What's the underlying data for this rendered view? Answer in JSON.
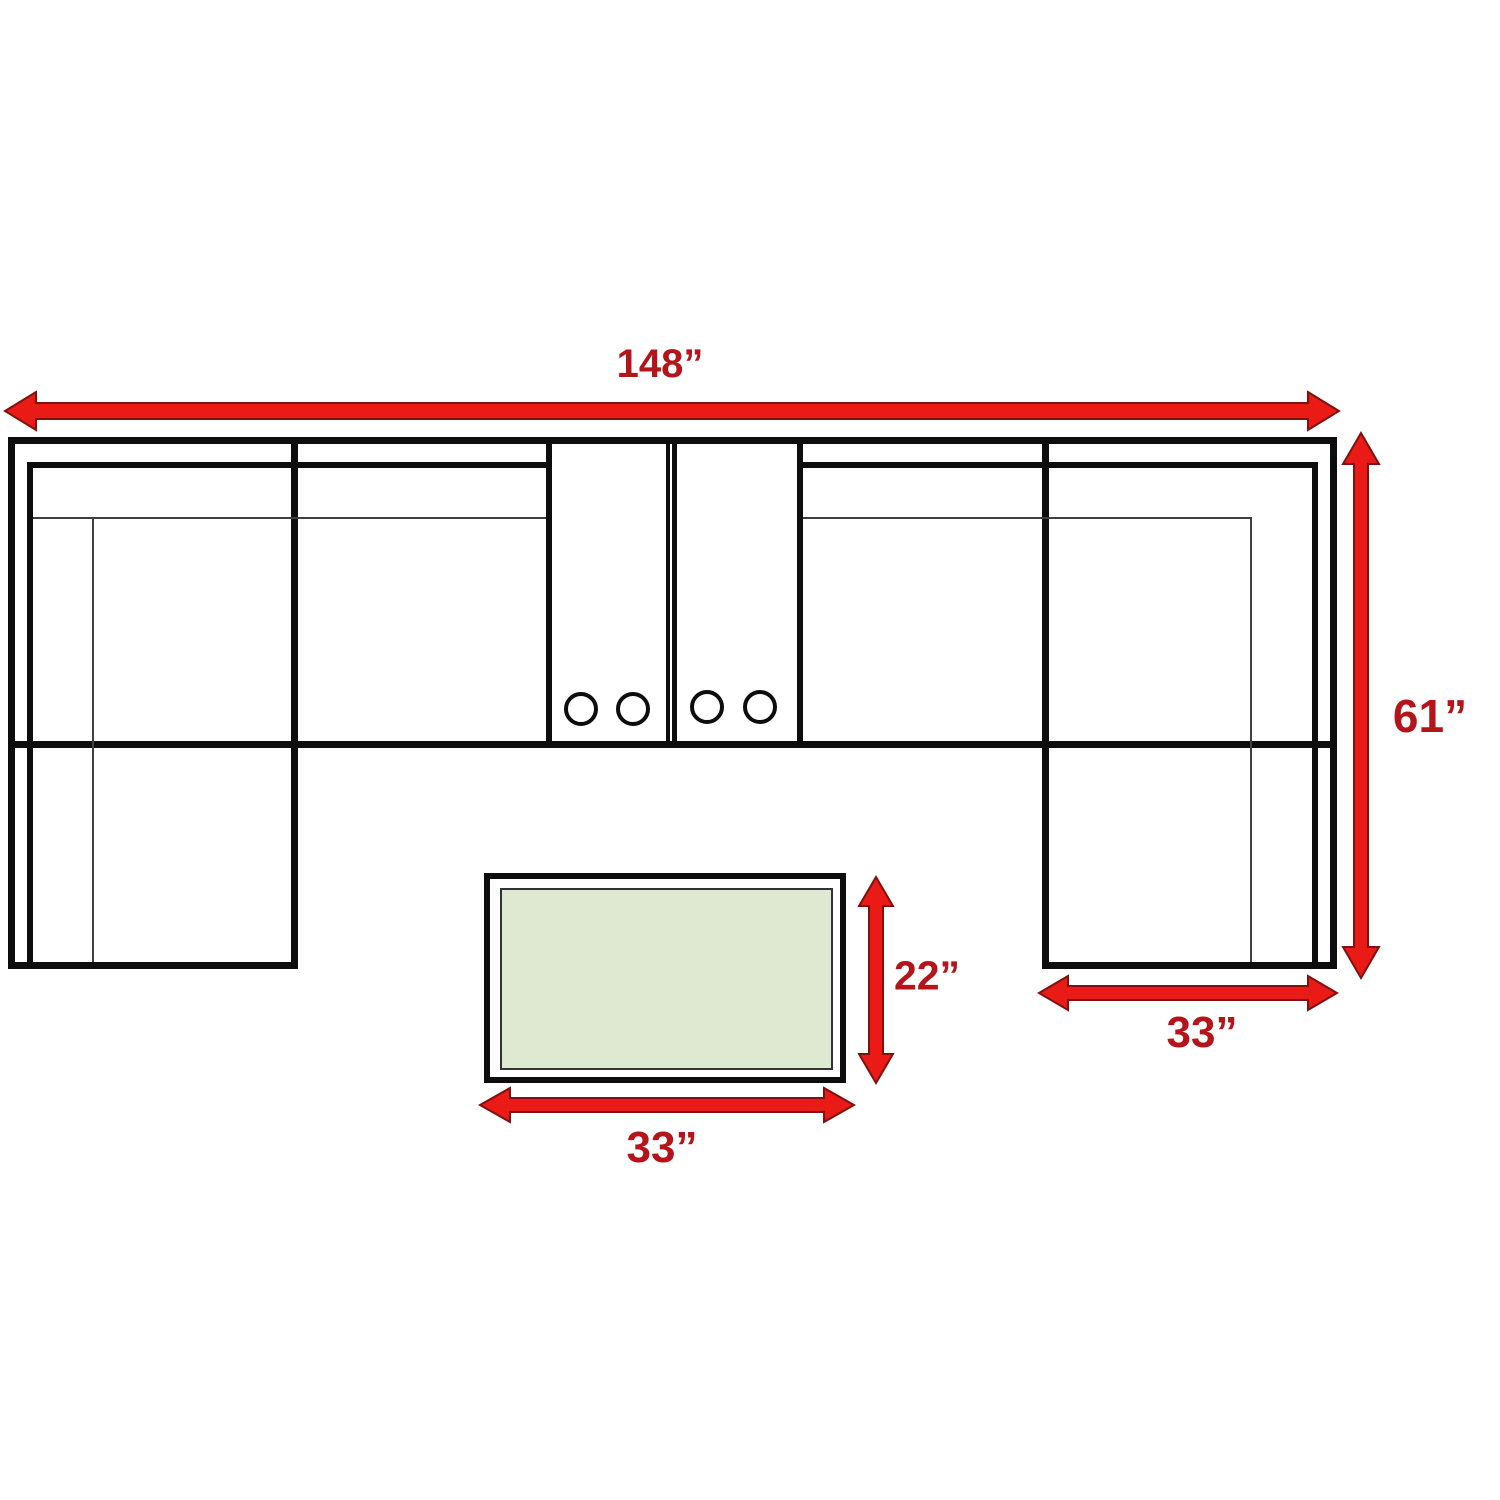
{
  "diagram": {
    "type": "sectional-sofa-floor-plan-with-dimensions",
    "labels": {
      "overall_width": "148”",
      "overall_depth": "61”",
      "chaise_width": "33”",
      "table_depth": "22”",
      "table_width": "33”"
    },
    "dimensions_inches": {
      "overall_width": 148,
      "overall_depth": 61,
      "chaise_width": 33,
      "table_depth": 22,
      "table_width": 33
    },
    "cup_holder_count": 4,
    "colors": {
      "arrow_red": "#ea1b17",
      "label_red": "#b5151a",
      "line_black": "#0d0d0d",
      "thin_line_gray": "#3f3f3f",
      "table_top_green": "#dfe9d2",
      "background": "#ffffff"
    }
  }
}
